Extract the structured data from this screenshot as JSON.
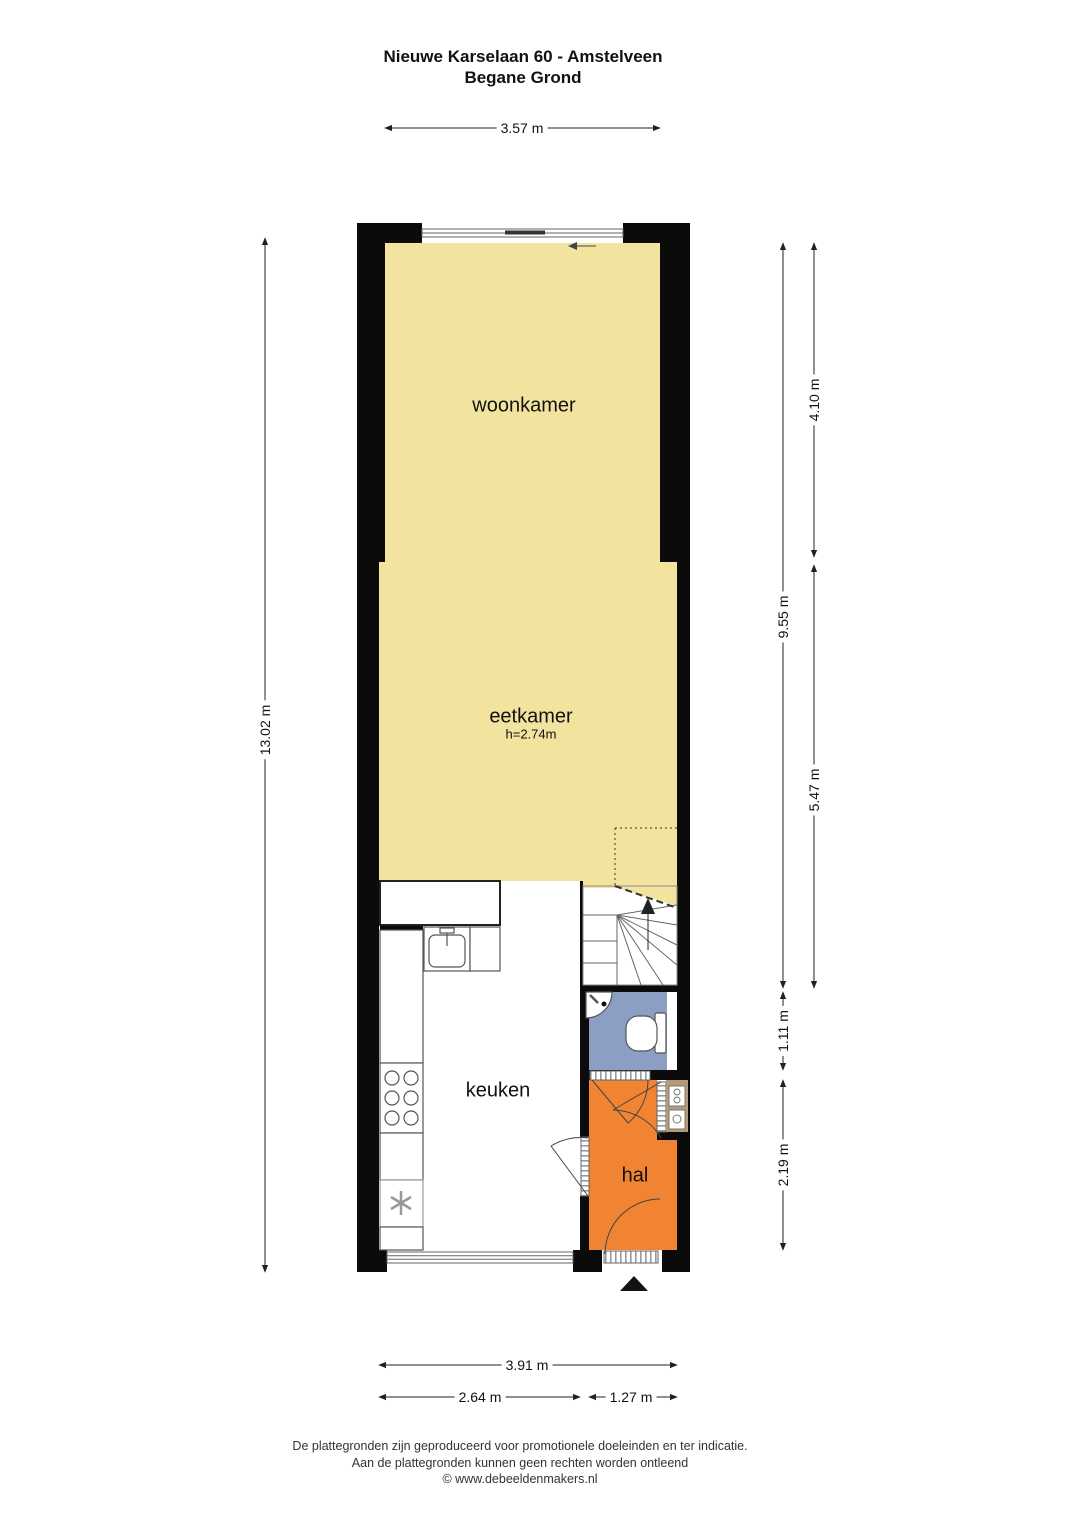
{
  "title": {
    "line1": "Nieuwe Karselaan 60 - Amstelveen",
    "line2": "Begane Grond"
  },
  "rooms": [
    {
      "id": "woonkamer",
      "label": "woonkamer"
    },
    {
      "id": "eetkamer",
      "label": "eetkamer",
      "height_note": "h=2.74m"
    },
    {
      "id": "keuken",
      "label": "keuken"
    },
    {
      "id": "hal",
      "label": "hal"
    }
  ],
  "dimensions": {
    "top_width": "3.57 m",
    "left_total_height": "13.02 m",
    "right_inner_total": "9.55 m",
    "right_woonkamer": "4.10 m",
    "right_eetkamer": "5.47 m",
    "right_toilet": "1.11 m",
    "right_hal": "2.19 m",
    "bottom_total": "3.91 m",
    "bottom_keuken": "2.64 m",
    "bottom_hal": "1.27 m"
  },
  "colors": {
    "room_fill": "#F2E39F",
    "hal_fill": "#F08433",
    "toilet_fill": "#8C9EC4",
    "meterkast_fill": "#B59B7A",
    "wall": "#0B0B0B",
    "fixture_stroke": "#555",
    "dim_line": "#222"
  },
  "footer": {
    "line1": "De plattegronden zijn geproduceerd voor promotionele doeleinden en ter indicatie.",
    "line2": "Aan de plattegronden kunnen geen rechten worden ontleend",
    "line3": "© www.debeeldenmakers.nl"
  }
}
